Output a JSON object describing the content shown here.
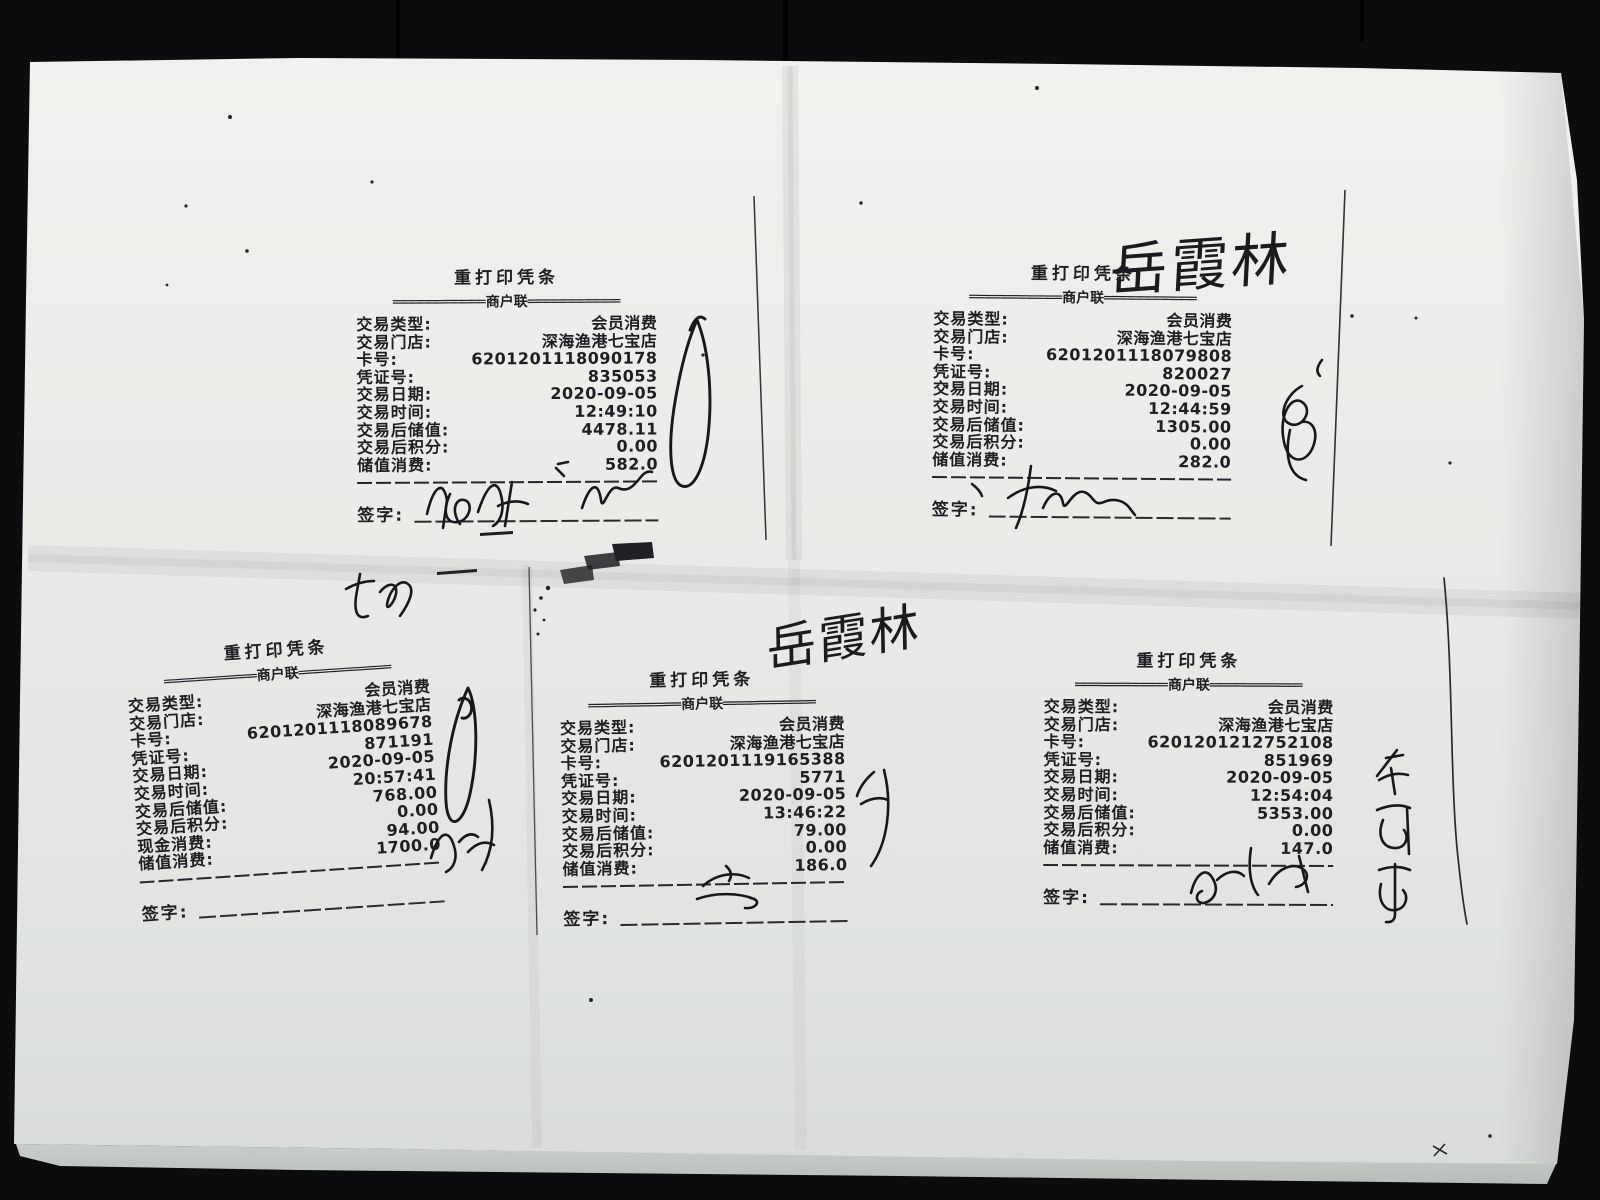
{
  "colors": {
    "background": "#0c0c0e",
    "paper": "#e9ebe8",
    "print_ink": "#1f1f23",
    "pen_ink": "#18181c"
  },
  "annotations": {
    "handwritten_name_1": "岳霞林",
    "handwritten_name_2": "岳霞林"
  },
  "receipts": [
    {
      "title": "重打印凭条",
      "divider": "═══════════商户联═══════════",
      "sign_label": "签字:",
      "rows": [
        {
          "label": "交易类型:",
          "value": "会员消费"
        },
        {
          "label": "交易门店:",
          "value": "深海渔港七宝店"
        },
        {
          "label": "卡号:",
          "value": "6201201118090178"
        },
        {
          "label": "凭证号:",
          "value": "835053"
        },
        {
          "label": "交易日期:",
          "value": "2020-09-05"
        },
        {
          "label": "交易时间:",
          "value": "12:49:10"
        },
        {
          "label": "交易后储值:",
          "value": "4478.11"
        },
        {
          "label": "交易后积分:",
          "value": "0.00"
        },
        {
          "label": "储值消费:",
          "value": "582.0"
        }
      ]
    },
    {
      "title": "重打印凭条",
      "divider": "═══════════商户联═══════════",
      "sign_label": "签字:",
      "rows": [
        {
          "label": "交易类型:",
          "value": "会员消费"
        },
        {
          "label": "交易门店:",
          "value": "深海渔港七宝店"
        },
        {
          "label": "卡号:",
          "value": "6201201118079808"
        },
        {
          "label": "凭证号:",
          "value": "820027"
        },
        {
          "label": "交易日期:",
          "value": "2020-09-05"
        },
        {
          "label": "交易时间:",
          "value": "12:44:59"
        },
        {
          "label": "交易后储值:",
          "value": "1305.00"
        },
        {
          "label": "交易后积分:",
          "value": "0.00"
        },
        {
          "label": "储值消费:",
          "value": "282.0"
        }
      ]
    },
    {
      "title": "重打印凭条",
      "divider": "═══════════商户联═══════════",
      "sign_label": "签字:",
      "rows": [
        {
          "label": "交易类型:",
          "value": "会员消费"
        },
        {
          "label": "交易门店:",
          "value": "深海渔港七宝店"
        },
        {
          "label": "卡号:",
          "value": "6201201118089678"
        },
        {
          "label": "凭证号:",
          "value": "871191"
        },
        {
          "label": "交易日期:",
          "value": "2020-09-05"
        },
        {
          "label": "交易时间:",
          "value": "20:57:41"
        },
        {
          "label": "交易后储值:",
          "value": "768.00"
        },
        {
          "label": "交易后积分:",
          "value": "0.00"
        },
        {
          "label": "现金消费:",
          "value": "94.00"
        },
        {
          "label": "储值消费:",
          "value": "1700.0"
        }
      ]
    },
    {
      "title": "重打印凭条",
      "divider": "═══════════商户联═══════════",
      "sign_label": "签字:",
      "rows": [
        {
          "label": "交易类型:",
          "value": "会员消费"
        },
        {
          "label": "交易门店:",
          "value": "深海渔港七宝店"
        },
        {
          "label": "卡号:",
          "value": "6201201119165388"
        },
        {
          "label": "凭证号:",
          "value": "5771"
        },
        {
          "label": "交易日期:",
          "value": "2020-09-05"
        },
        {
          "label": "交易时间:",
          "value": "13:46:22"
        },
        {
          "label": "交易后储值:",
          "value": "79.00"
        },
        {
          "label": "交易后积分:",
          "value": "0.00"
        },
        {
          "label": "储值消费:",
          "value": "186.0"
        }
      ]
    },
    {
      "title": "重打印凭条",
      "divider": "═══════════商户联═══════════",
      "sign_label": "签字:",
      "rows": [
        {
          "label": "交易类型:",
          "value": "会员消费"
        },
        {
          "label": "交易门店:",
          "value": "深海渔港七宝店"
        },
        {
          "label": "卡号:",
          "value": "6201201212752108"
        },
        {
          "label": "凭证号:",
          "value": "851969"
        },
        {
          "label": "交易日期:",
          "value": "2020-09-05"
        },
        {
          "label": "交易时间:",
          "value": "12:54:04"
        },
        {
          "label": "交易后储值:",
          "value": "5353.00"
        },
        {
          "label": "交易后积分:",
          "value": "0.00"
        },
        {
          "label": "储值消费:",
          "value": "147.0"
        }
      ]
    }
  ]
}
